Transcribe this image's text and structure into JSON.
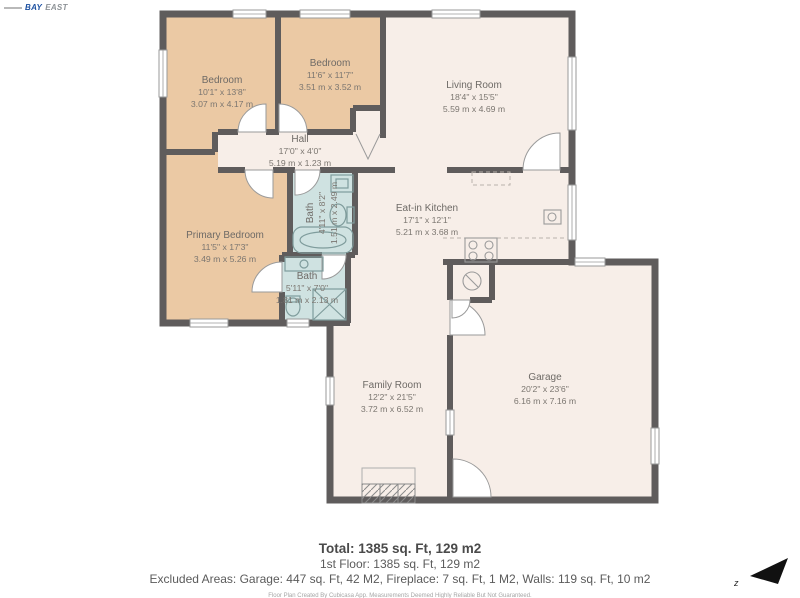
{
  "logo": {
    "text_primary": "BAY",
    "text_secondary": "EAST"
  },
  "rooms": [
    {
      "name": "Bedroom",
      "dims_ft": "10'1\" x 13'8\"",
      "dims_m": "3.07 m x 4.17 m"
    },
    {
      "name": "Bedroom",
      "dims_ft": "11'6\" x 11'7\"",
      "dims_m": "3.51 m x 3.52 m"
    },
    {
      "name": "Living Room",
      "dims_ft": "18'4\" x 15'5\"",
      "dims_m": "5.59 m x 4.69 m"
    },
    {
      "name": "Hall",
      "dims_ft": "17'0\" x 4'0\"",
      "dims_m": "5.19 m x 1.23 m"
    },
    {
      "name": "Bath",
      "dims_ft": "4'11\" x 8'2\"",
      "dims_m": "1.51 m x 2.49 m"
    },
    {
      "name": "Primary Bedroom",
      "dims_ft": "11'5\" x 17'3\"",
      "dims_m": "3.49 m x 5.26 m"
    },
    {
      "name": "Eat-in Kitchen",
      "dims_ft": "17'1\" x 12'1\"",
      "dims_m": "5.21 m x 3.68 m"
    },
    {
      "name": "Bath",
      "dims_ft": "5'11\" x 7'0\"",
      "dims_m": "1.81 m x 2.13 m"
    },
    {
      "name": "Family Room",
      "dims_ft": "12'2\" x 21'5\"",
      "dims_m": "3.72 m x 6.52 m"
    },
    {
      "name": "Garage",
      "dims_ft": "20'2\" x 23'6\"",
      "dims_m": "6.16 m x 7.16 m"
    }
  ],
  "summary": {
    "total": "Total: 1385 sq. Ft, 129 m2",
    "first_floor": "1st Floor: 1385 sq. Ft, 129 m2",
    "excluded": "Excluded Areas: Garage: 447 sq. Ft, 42 M2, Fireplace: 7 sq. Ft, 1 M2, Walls: 119 sq. Ft, 10 m2",
    "disclaimer": "Floor Plan Created By Cubicasa App. Measurements Deemed Highly Reliable But Not Guaranteed."
  },
  "compass": {
    "label": "z"
  },
  "colors": {
    "wall": "#5f5c5c",
    "bedroom_fill": "#ebc9a4",
    "common_fill": "#f7eee8",
    "bath_fill": "#cfe2e1",
    "logo_blue": "#1b4fa0"
  }
}
